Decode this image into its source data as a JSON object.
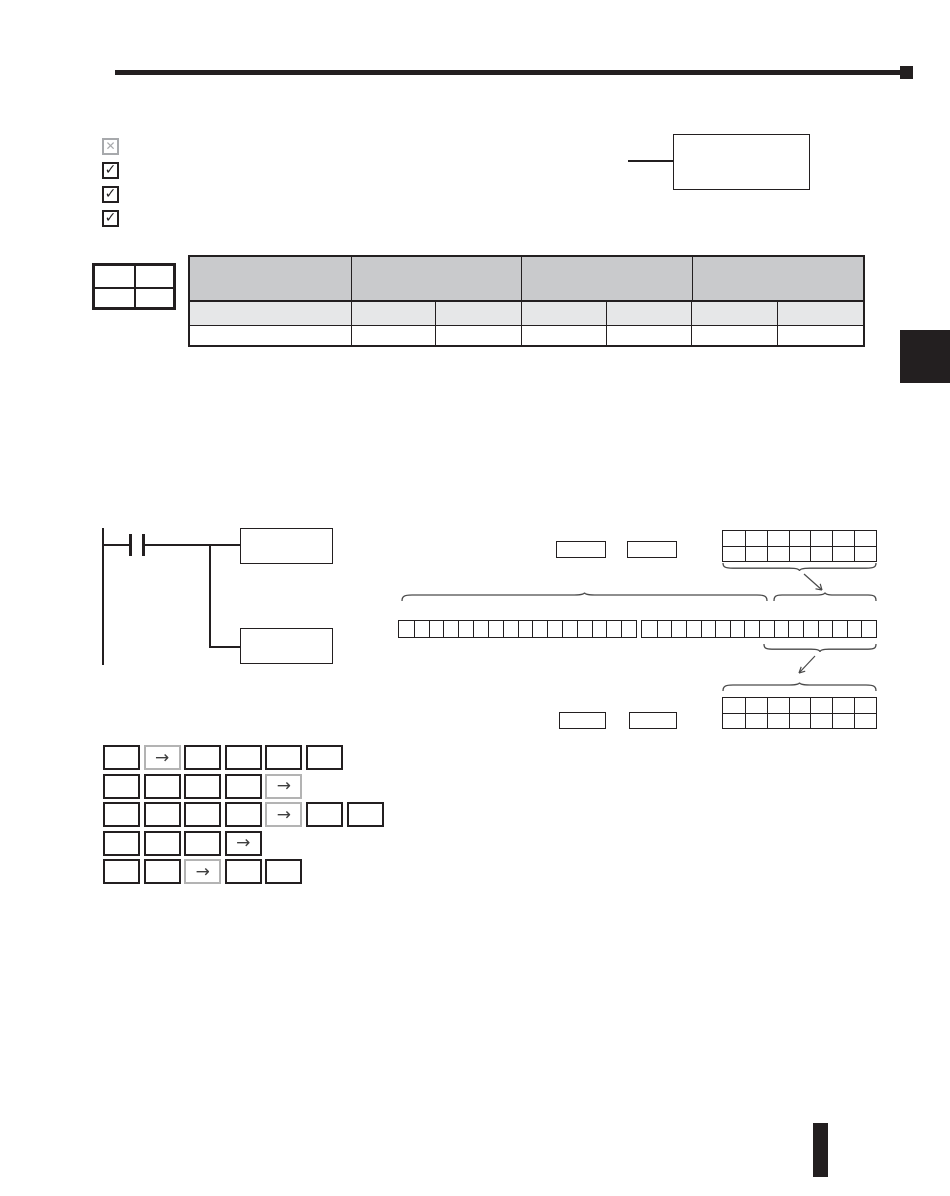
{
  "page": {
    "kind": "scanned-manual-page",
    "background": "#ffffff",
    "ink_color": "#231f20"
  },
  "header": {
    "rule_icon": "horizontal-rule",
    "end_icon": "black-square"
  },
  "checklist": [
    {
      "icon": "x-checkbox-icon",
      "state": "excluded",
      "glyph": "✕",
      "color": "#a7a9ac"
    },
    {
      "icon": "checked-checkbox-icon",
      "state": "checked",
      "glyph": "✓",
      "color": "#231f20"
    },
    {
      "icon": "checked-checkbox-icon",
      "state": "checked",
      "glyph": "✓",
      "color": "#231f20"
    },
    {
      "icon": "checked-checkbox-icon",
      "state": "checked",
      "glyph": "✓",
      "color": "#231f20"
    }
  ],
  "callout": {
    "text": "",
    "leader": "left-line"
  },
  "mini_table": {
    "rows": 2,
    "cols": 2
  },
  "spec_table": {
    "header_cells": 4,
    "sub_cells": 7,
    "body_cells": 7,
    "header_fill": "#c9cacc",
    "sub_fill": "#e6e7e8",
    "body_fill": "#ffffff"
  },
  "side_tab": {
    "icon": "chapter-tab",
    "color": "#231f20"
  },
  "ladder": {
    "contact_icon": "normally-open-contact",
    "output_boxes": 2
  },
  "bit_figure": {
    "top_label_boxes": 2,
    "bottom_label_boxes": 2,
    "word_grid": {
      "cols": 7,
      "rows": 2
    },
    "bit_groups": [
      16,
      16
    ],
    "annotations": [
      "underbrace",
      "arrow-down-right",
      "overbrace-long",
      "overbrace-short",
      "underbrace",
      "arrow-down-left",
      "overbrace"
    ],
    "annotation_color": "#4a4a4a"
  },
  "keypad": {
    "arrow_glyph": "→",
    "rows": [
      {
        "keys": 6,
        "arrow_index": 1,
        "arrow_style": "gray"
      },
      {
        "keys": 5,
        "arrow_index": 4,
        "arrow_style": "gray"
      },
      {
        "keys": 7,
        "arrow_index": 4,
        "arrow_style": "gray"
      },
      {
        "keys": 4,
        "arrow_index": 3,
        "arrow_style": "black"
      },
      {
        "keys": 5,
        "arrow_index": 2,
        "arrow_style": "gray"
      }
    ]
  },
  "footer": {
    "icon": "black-page-bar"
  }
}
